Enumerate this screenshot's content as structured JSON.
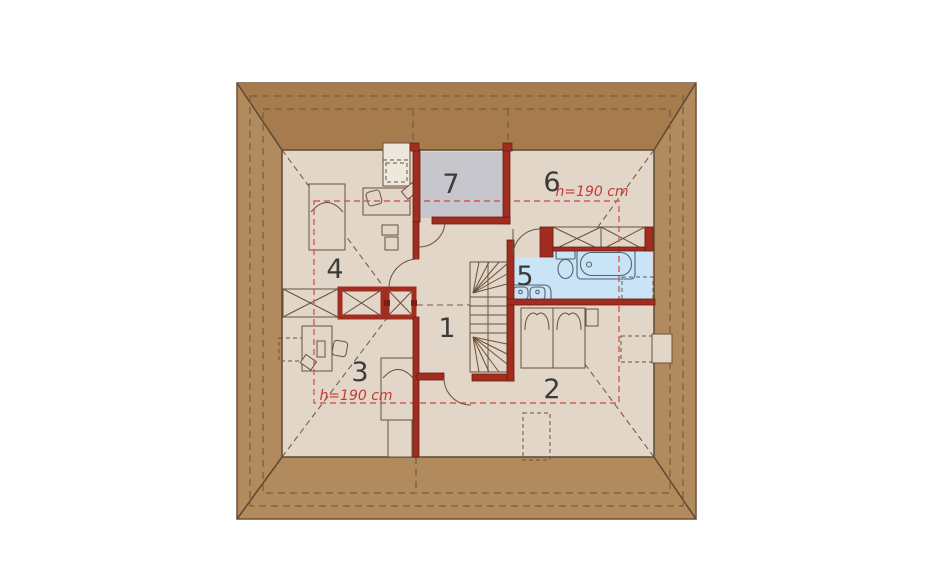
{
  "plan": {
    "type": "attic floor plan",
    "room_numbers": [
      "1",
      "2",
      "3",
      "4",
      "5",
      "6",
      "7"
    ],
    "height_annotations": [
      "h=190 cm",
      "h=190 cm"
    ],
    "colors": {
      "background": "#FFFFFF",
      "roof_side": "#B18A5E",
      "roof_top": "#A67C4F",
      "roof_line": "#6E5136",
      "floor": "#E2D6C8",
      "wardrobe_room_fill": "#C7C6CC",
      "bathroom_fill": "#C9E4F6",
      "wall_red": "#A12C20",
      "height_contour": "#D25C55",
      "room_label": "#3B3B3B",
      "annotation_red": "#C33B36"
    }
  }
}
